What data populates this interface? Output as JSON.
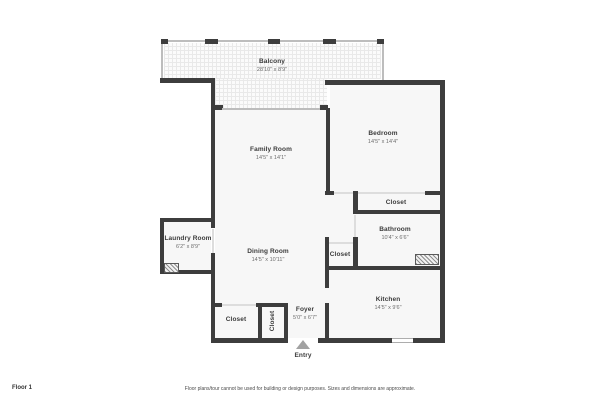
{
  "plan": {
    "rooms": {
      "balcony": {
        "name": "Balcony",
        "dims": "28'10\" x 8'9\""
      },
      "family_room": {
        "name": "Family Room",
        "dims": "14'5\" x 14'1\""
      },
      "bedroom": {
        "name": "Bedroom",
        "dims": "14'5\" x 14'4\""
      },
      "bedroom_closet": {
        "name": "Closet"
      },
      "bathroom": {
        "name": "Bathroom",
        "dims": "10'4\" x 6'6\""
      },
      "laundry_room": {
        "name": "Laundry Room",
        "dims": "6'2\" x 8'9\""
      },
      "dining_room": {
        "name": "Dining Room",
        "dims": "14'5\" x 10'11\""
      },
      "hall_closet": {
        "name": "Closet"
      },
      "kitchen": {
        "name": "Kitchen",
        "dims": "14'5\" x 9'6\""
      },
      "foyer": {
        "name": "Foyer",
        "dims": "5'0\" x 6'7\""
      },
      "entry_closet_left": {
        "name": "Closet"
      },
      "entry_closet_right": {
        "name": "Closet"
      }
    },
    "entry_label": "Entry",
    "colors": {
      "wall": "#3d3d3d",
      "floor": "#f7f7f7",
      "accent_light": "#bdbdbd"
    }
  },
  "footer": {
    "floor_label": "Floor 1",
    "disclaimer": "Floor plans/tour cannot be used for building or design purposes. Sizes and dimensions are approximate."
  }
}
